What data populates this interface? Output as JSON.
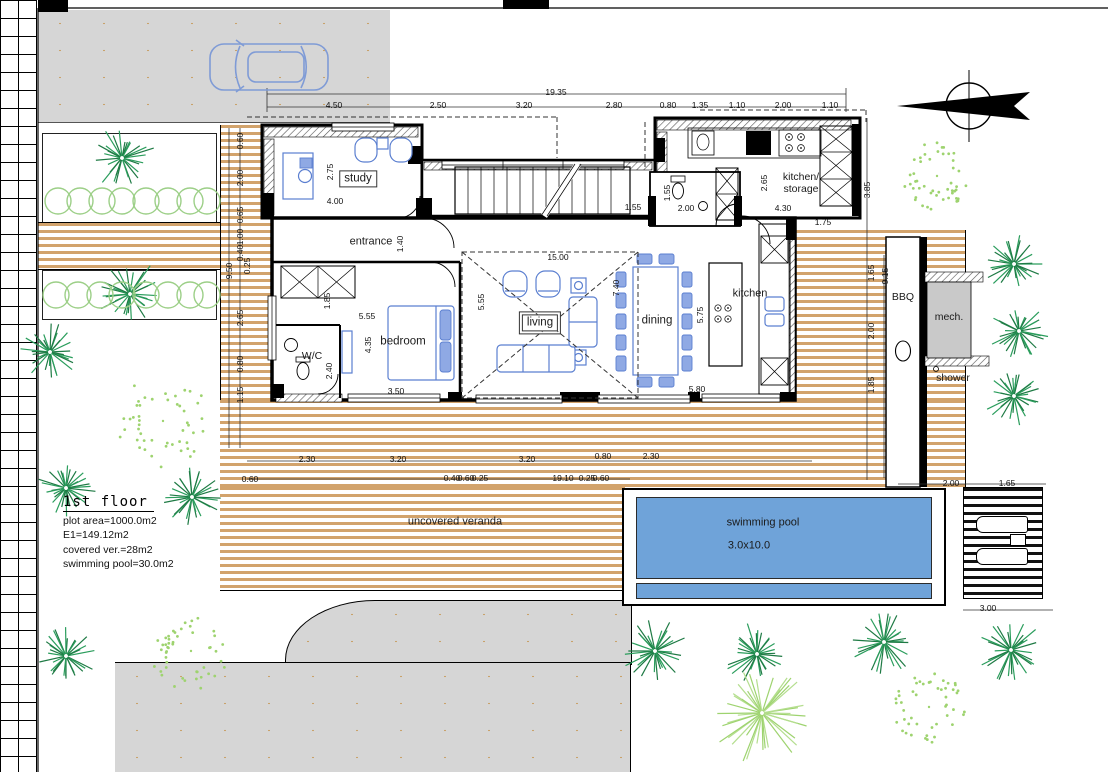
{
  "title_block": {
    "title": "1st floor",
    "lines": [
      "plot area=1000.0m2",
      "E1=149.12m2",
      "covered ver.=28m2",
      "swimming pool=30.0m2"
    ]
  },
  "labels": [
    {
      "name": "study",
      "text": "study",
      "x": 358,
      "y": 179,
      "boxed": true,
      "fs": 11.5
    },
    {
      "name": "entrance",
      "text": "entrance",
      "x": 371,
      "y": 242
    },
    {
      "name": "bedroom",
      "text": "bedroom",
      "x": 403,
      "y": 342,
      "fs": 11.5
    },
    {
      "name": "wc",
      "text": "W/C",
      "x": 312,
      "y": 356,
      "fs": 10.5
    },
    {
      "name": "living",
      "text": "living",
      "x": 540,
      "y": 323,
      "boxed": true,
      "double": true,
      "fs": 11.5
    },
    {
      "name": "dining",
      "text": "dining",
      "x": 657,
      "y": 321,
      "fs": 11.5
    },
    {
      "name": "kitchen",
      "text": "kitchen",
      "x": 750,
      "y": 294
    },
    {
      "name": "kitchen-storage",
      "text": "kitchen/\nstorage",
      "x": 801,
      "y": 183,
      "fs": 10.5
    },
    {
      "name": "bbq",
      "text": "BBQ",
      "x": 903,
      "y": 297,
      "fs": 10.5
    },
    {
      "name": "mech",
      "text": "mech.",
      "x": 949,
      "y": 317,
      "fs": 10.5
    },
    {
      "name": "shower",
      "text": "shower",
      "x": 953,
      "y": 378,
      "fs": 10.5
    },
    {
      "name": "veranda",
      "text": "uncovered veranda",
      "x": 455,
      "y": 522
    },
    {
      "name": "pool-label",
      "text": "swimming pool",
      "x": 763,
      "y": 523
    },
    {
      "name": "pool-size",
      "text": "3.0x10.0",
      "x": 749,
      "y": 546
    }
  ],
  "dimensions": [
    {
      "t": "19.35",
      "x": 556,
      "y": 92
    },
    {
      "t": "4.50",
      "x": 334,
      "y": 105
    },
    {
      "t": "2.50",
      "x": 438,
      "y": 105
    },
    {
      "t": "3.20",
      "x": 524,
      "y": 105
    },
    {
      "t": "2.80",
      "x": 614,
      "y": 105
    },
    {
      "t": "0.80",
      "x": 668,
      "y": 105
    },
    {
      "t": "1.35",
      "x": 700,
      "y": 105
    },
    {
      "t": "1.10",
      "x": 737,
      "y": 105
    },
    {
      "t": "2.00",
      "x": 783,
      "y": 105
    },
    {
      "t": "1.10",
      "x": 830,
      "y": 105
    },
    {
      "t": "0.60",
      "x": 240,
      "y": 141,
      "v": 1
    },
    {
      "t": "2.00",
      "x": 240,
      "y": 178,
      "v": 1
    },
    {
      "t": "0.65",
      "x": 240,
      "y": 215,
      "v": 1
    },
    {
      "t": "1.00",
      "x": 240,
      "y": 237,
      "v": 1
    },
    {
      "t": "0.40",
      "x": 240,
      "y": 253,
      "v": 1
    },
    {
      "t": "0.25",
      "x": 247,
      "y": 266,
      "v": 1
    },
    {
      "t": "9.50",
      "x": 229,
      "y": 271,
      "v": 1
    },
    {
      "t": "2.65",
      "x": 240,
      "y": 318,
      "v": 1
    },
    {
      "t": "0.80",
      "x": 240,
      "y": 364,
      "v": 1
    },
    {
      "t": "1.15",
      "x": 240,
      "y": 395,
      "v": 1
    },
    {
      "t": "3.85",
      "x": 867,
      "y": 190,
      "v": 1
    },
    {
      "t": "1.65",
      "x": 871,
      "y": 273,
      "v": 1
    },
    {
      "t": "9.15",
      "x": 885,
      "y": 276,
      "v": 1
    },
    {
      "t": "2.00",
      "x": 871,
      "y": 331,
      "v": 1
    },
    {
      "t": "1.85",
      "x": 871,
      "y": 385,
      "v": 1
    },
    {
      "t": "2.30",
      "x": 307,
      "y": 459
    },
    {
      "t": "3.20",
      "x": 398,
      "y": 459
    },
    {
      "t": "3.20",
      "x": 527,
      "y": 459
    },
    {
      "t": "0.80",
      "x": 603,
      "y": 456
    },
    {
      "t": "2.30",
      "x": 651,
      "y": 456
    },
    {
      "t": "0.60",
      "x": 250,
      "y": 479
    },
    {
      "t": "0.40",
      "x": 452,
      "y": 478
    },
    {
      "t": "0.60",
      "x": 466,
      "y": 478
    },
    {
      "t": "0.25",
      "x": 480,
      "y": 478
    },
    {
      "t": "19.10",
      "x": 563,
      "y": 478
    },
    {
      "t": "0.25",
      "x": 587,
      "y": 478
    },
    {
      "t": "0.60",
      "x": 601,
      "y": 478
    },
    {
      "t": "2.00",
      "x": 951,
      "y": 483
    },
    {
      "t": "1.65",
      "x": 1007,
      "y": 483
    },
    {
      "t": "3.00",
      "x": 988,
      "y": 608
    },
    {
      "t": "2.75",
      "x": 330,
      "y": 172,
      "v": 1
    },
    {
      "t": "4.00",
      "x": 335,
      "y": 201
    },
    {
      "t": "1.40",
      "x": 400,
      "y": 244,
      "v": 1
    },
    {
      "t": "1.55",
      "x": 633,
      "y": 207
    },
    {
      "t": "1.55",
      "x": 667,
      "y": 193,
      "v": 1
    },
    {
      "t": "2.00",
      "x": 686,
      "y": 208
    },
    {
      "t": "2.65",
      "x": 764,
      "y": 183,
      "v": 1
    },
    {
      "t": "4.30",
      "x": 783,
      "y": 208
    },
    {
      "t": "1.75",
      "x": 823,
      "y": 222
    },
    {
      "t": "1.85",
      "x": 327,
      "y": 301,
      "v": 1
    },
    {
      "t": "5.55",
      "x": 367,
      "y": 316
    },
    {
      "t": "4.35",
      "x": 368,
      "y": 345,
      "v": 1
    },
    {
      "t": "3.50",
      "x": 396,
      "y": 391
    },
    {
      "t": "2.40",
      "x": 329,
      "y": 371,
      "v": 1
    },
    {
      "t": "5.55",
      "x": 481,
      "y": 302,
      "v": 1
    },
    {
      "t": "15.00",
      "x": 558,
      "y": 257
    },
    {
      "t": "7.40",
      "x": 616,
      "y": 288,
      "v": 1
    },
    {
      "t": "5.75",
      "x": 700,
      "y": 315,
      "v": 1
    },
    {
      "t": "5.80",
      "x": 697,
      "y": 389
    }
  ],
  "trees": [
    {
      "k": "palm",
      "x": 122,
      "y": 158,
      "r": 34
    },
    {
      "k": "palm",
      "x": 130,
      "y": 294,
      "r": 36
    },
    {
      "k": "palm",
      "x": 50,
      "y": 352,
      "r": 30
    },
    {
      "k": "palm",
      "x": 66,
      "y": 488,
      "r": 30
    },
    {
      "k": "palm",
      "x": 192,
      "y": 497,
      "r": 30
    },
    {
      "k": "palm",
      "x": 66,
      "y": 656,
      "r": 32
    },
    {
      "k": "palm",
      "x": 1014,
      "y": 264,
      "r": 30
    },
    {
      "k": "palm",
      "x": 1019,
      "y": 331,
      "r": 30
    },
    {
      "k": "palm",
      "x": 1014,
      "y": 396,
      "r": 30
    },
    {
      "k": "palm",
      "x": 655,
      "y": 651,
      "r": 33
    },
    {
      "k": "palm",
      "x": 757,
      "y": 654,
      "r": 33
    },
    {
      "k": "palm",
      "x": 884,
      "y": 642,
      "r": 33
    },
    {
      "k": "palm",
      "x": 1011,
      "y": 650,
      "r": 33
    },
    {
      "k": "bush",
      "x": 937,
      "y": 176,
      "r": 34
    },
    {
      "k": "bush",
      "x": 163,
      "y": 421,
      "r": 46
    },
    {
      "k": "bush",
      "x": 191,
      "y": 651,
      "r": 40
    },
    {
      "k": "bush",
      "x": 929,
      "y": 707,
      "r": 36
    },
    {
      "k": "burst",
      "x": 762,
      "y": 713,
      "r": 52
    }
  ],
  "hedges": [
    {
      "y": 201,
      "r": 13,
      "cx": [
        58,
        80,
        102,
        122,
        146,
        168,
        190,
        207
      ]
    },
    {
      "y": 295,
      "r": 13,
      "cx": [
        56,
        78,
        100,
        122,
        146,
        168,
        190,
        207
      ]
    }
  ],
  "colors": {
    "deck_stripe": "#d2a36c",
    "pool_water": "#6fa3d9",
    "pavement": "#d6d6d6",
    "mech_fill": "#c9c9c9",
    "tree_dark": "#2a9d5c",
    "hedge_light": "#9ccf87",
    "bush_light": "#9ed36f",
    "furniture_stroke": "#5b7fd0",
    "furniture_fill": "#8fa9e4",
    "wall": "#000000"
  }
}
